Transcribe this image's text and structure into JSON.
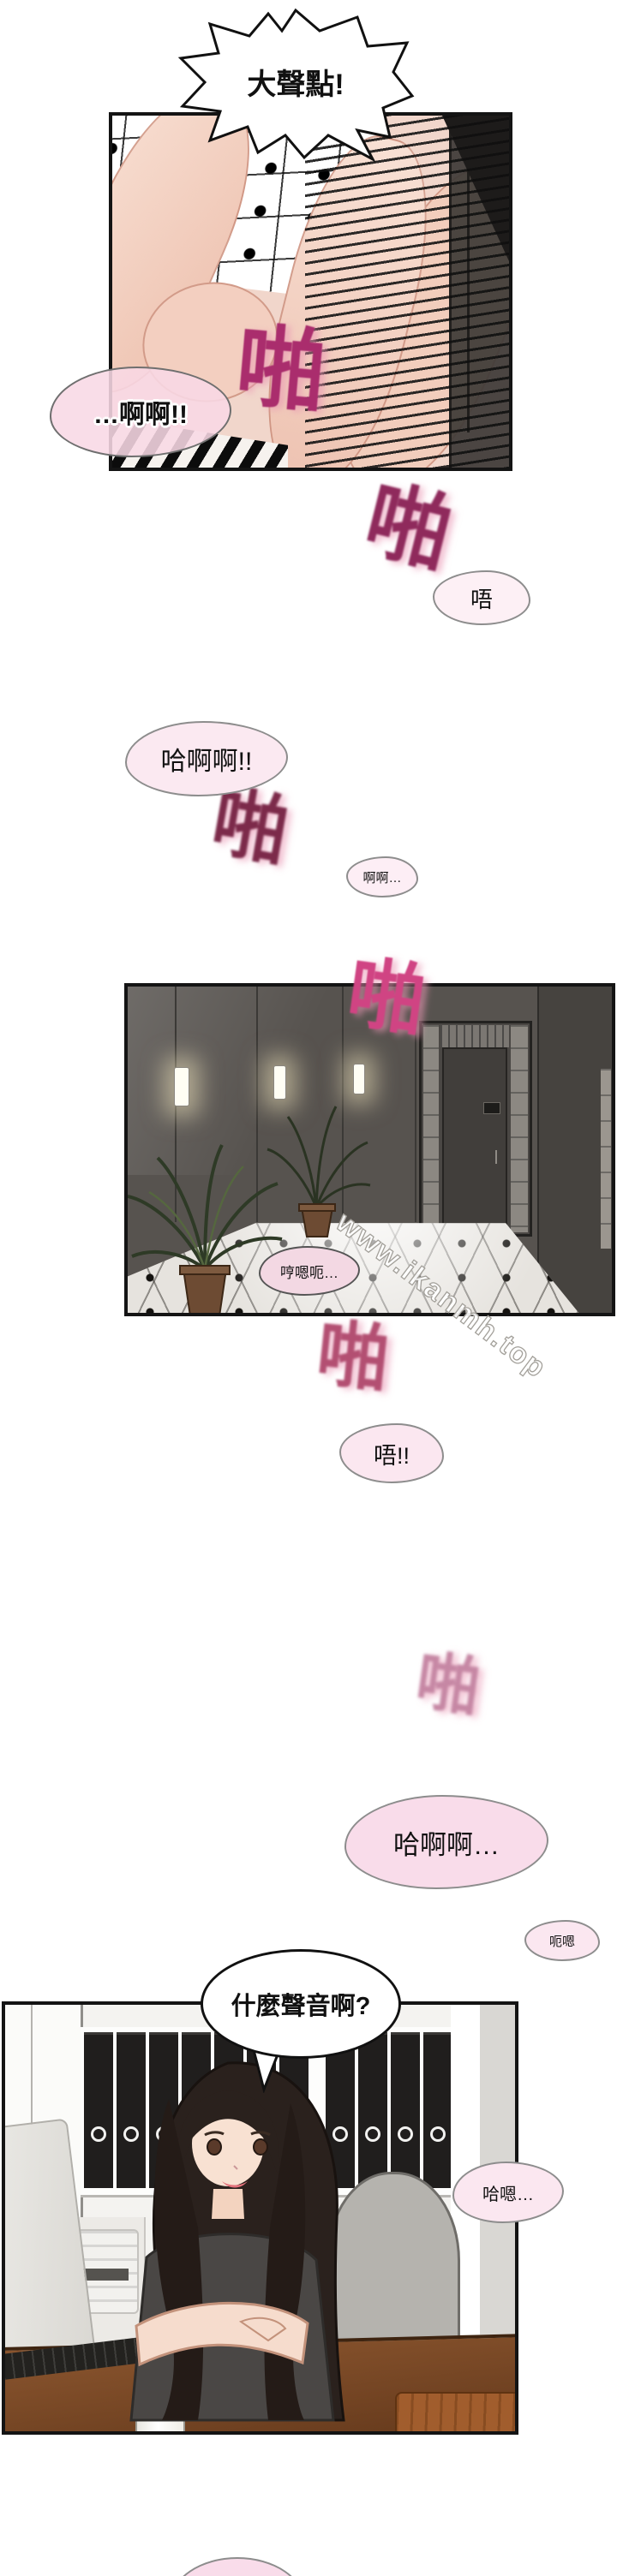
{
  "speech": {
    "shout": "大聲點!",
    "moan_panel1": "…啊啊!!",
    "wu": "唔",
    "ha_ah_ah": "哈啊啊!!",
    "ah_ah": "啊啊…",
    "hng": "哼嗯呃…",
    "wu2": "唔!!",
    "ha_ah_ah2": "哈啊啊…",
    "eh_ng": "呃嗯",
    "question": "什麼聲音啊?",
    "ha_ng": "哈嗯…"
  },
  "sfx": {
    "slap": "啪"
  },
  "watermark": "www.ikanmh.top",
  "colors": {
    "bubble_pink": "#fbe7f0",
    "bubble_outline": "#8d8d8d",
    "panel_border": "#141414",
    "sfx_magenta_dark": "#7c2a4a",
    "sfx_magenta_bright": "#d04483",
    "hall_wall": "#57534f",
    "skin_tone": "#f2cdbc",
    "desk_wood": "#8a552e"
  }
}
